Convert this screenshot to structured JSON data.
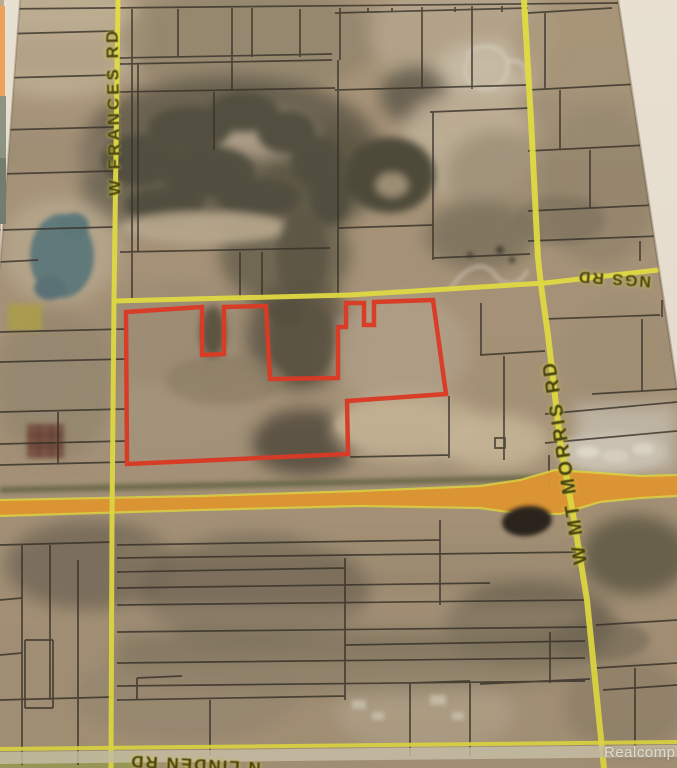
{
  "map": {
    "watermark": "Realcomp",
    "roads": {
      "frances": {
        "label": "W FRANCES RD"
      },
      "ngs": {
        "label": "NGS RD"
      },
      "mt_morris": {
        "label": "W MT MORRIS RD"
      },
      "linden": {
        "label": "N LINDEN RD"
      }
    },
    "colors": {
      "subject_outline": "#e0341f",
      "road_yellow": "#e5df3e",
      "highway_orange": "#e6982e",
      "parcel_line": "#2d2820",
      "paper_edge": "#ece4d6",
      "road_label": "#3d3908"
    }
  }
}
